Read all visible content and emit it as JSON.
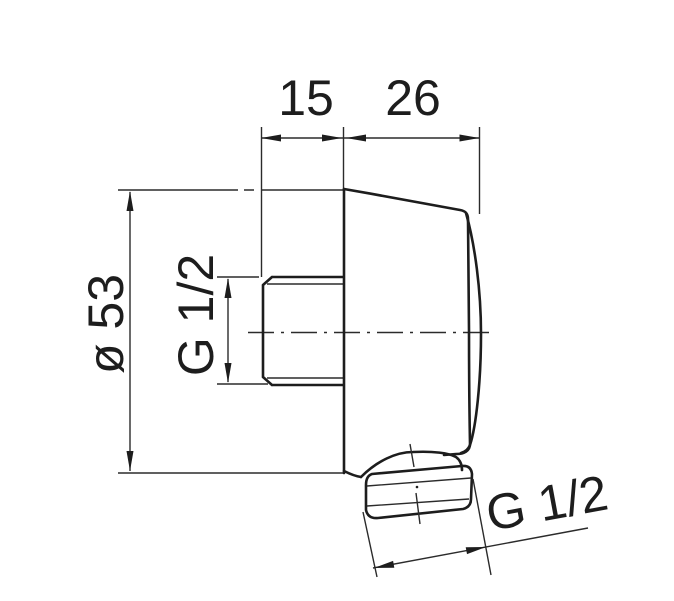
{
  "drawing": {
    "type": "technical-dimension-drawing",
    "subject": "wall-mounted shower outlet elbow, side view",
    "colors": {
      "line": "#1d1d1d",
      "background": "#ffffff"
    },
    "dimensions": {
      "top_left_width": "15",
      "top_right_width": "26",
      "body_diameter": "ø 53",
      "wall_thread": "G 1/2",
      "outlet_thread": "G 1/2"
    }
  }
}
